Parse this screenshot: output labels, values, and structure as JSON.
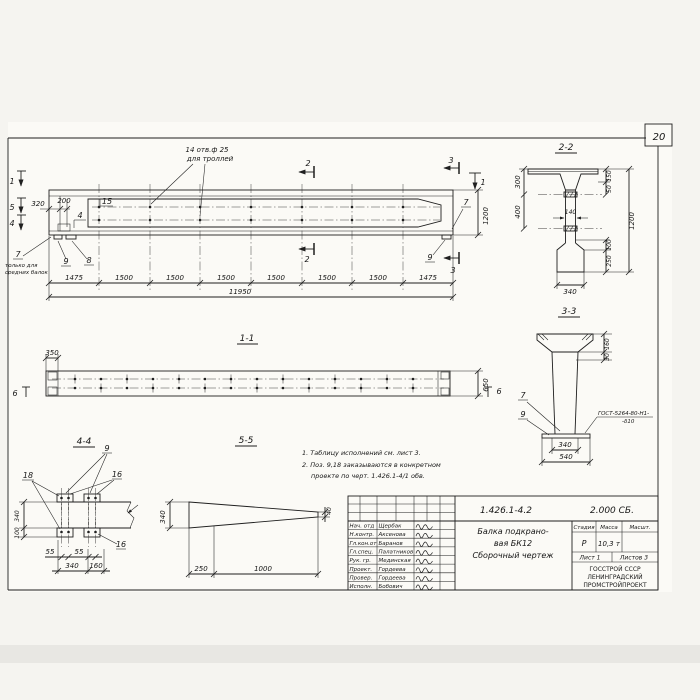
{
  "sheet": {
    "number": "20",
    "ink_color": "#1f1f1f",
    "paper_color": "#f5f4f0"
  },
  "elevation": {
    "marker_1": "1",
    "marker_5": "5",
    "marker_4": "4",
    "marker_2": "2",
    "marker_3": "3",
    "holes_note_1": "14 отв.ф 25",
    "holes_note_2": "для троллей",
    "callout_15": "15",
    "callout_4": "4",
    "callout_7": "7",
    "callout_8": "8",
    "callout_9": "9",
    "callout_7_right": "7",
    "callout_9_right": "9",
    "mid_note_1": "только для",
    "mid_note_2": "средних балок",
    "dim_320": "320",
    "dim_200": "200",
    "dim_1200": "1200",
    "dim_total": "11950",
    "chain": [
      "1475",
      "1500",
      "1500",
      "1500",
      "1500",
      "1500",
      "1500",
      "1475"
    ]
  },
  "section11": {
    "label": "1-1",
    "dim_350": "350",
    "dim_650": "650",
    "marker_6_left": "6",
    "marker_6_right": "6"
  },
  "section22": {
    "label": "2-2",
    "dim_300": "300",
    "dim_400": "400",
    "dim_140": "140",
    "dim_150": "150",
    "dim_50": "50",
    "dim_1200": "1200",
    "dim_100": "100",
    "dim_250": "250",
    "dim_340": "340"
  },
  "section33": {
    "label": "3-3",
    "dim_160": "160",
    "dim_30": "30",
    "dim_340": "340",
    "dim_540": "540",
    "callout_7": "7",
    "callout_9": "9",
    "weld_note_1": "ГОСТ-5264-80-Н1-",
    "weld_note_2": "-δ10"
  },
  "section44": {
    "label": "4-4",
    "callout_9": "9",
    "callout_16": "16",
    "callout_16b": "16",
    "callout_18": "18",
    "dim_340_v": "340",
    "dim_100": "100",
    "dim_55_a": "55",
    "dim_55_b": "55",
    "dim_340": "340",
    "dim_160": "160"
  },
  "section55": {
    "label": "5-5",
    "dim_340": "340",
    "dim_250": "250",
    "dim_1000": "1000",
    "dim_40": "40"
  },
  "notes": {
    "line_1": "1. Таблицу исполнений см. лист 3.",
    "line_2": "2. Поз. 9,18 заказываются в конкретном",
    "line_3": "проекте по черт. 1.426.1-4/1 обв."
  },
  "stamp": {
    "doc_number": "1.426.1-4.2",
    "doc_code": "2.000 СБ.",
    "title_1": "Балка подкрано-",
    "title_2": "вая БК12",
    "title_3": "Сборочный чертеж",
    "stage_header": "Стадия",
    "mass_header": "Масса",
    "scale_header": "Масшт.",
    "stage": "Р",
    "mass": "10,3 т",
    "sheet_label": "Лист 1",
    "sheets_label": "Листов 3",
    "org_1": "ГОССТРОЙ СССР",
    "org_2": "ЛЕНИНГРАДСКИЙ",
    "org_3": "ПРОМСТРОЙПРОЕКТ",
    "rows": [
      {
        "role": "Нач. отд",
        "name": "Щербак"
      },
      {
        "role": "Н.контр.",
        "name": "Аксенова"
      },
      {
        "role": "Гл.кон.от",
        "name": "Баранов"
      },
      {
        "role": "Гл.спец.",
        "name": "Палатников"
      },
      {
        "role": "Рук. гр.",
        "name": "Мединская"
      },
      {
        "role": "Проект.",
        "name": "Гордеева"
      },
      {
        "role": "Провер.",
        "name": "Гордеева"
      },
      {
        "role": "Исполн.",
        "name": "Бобович"
      }
    ]
  }
}
